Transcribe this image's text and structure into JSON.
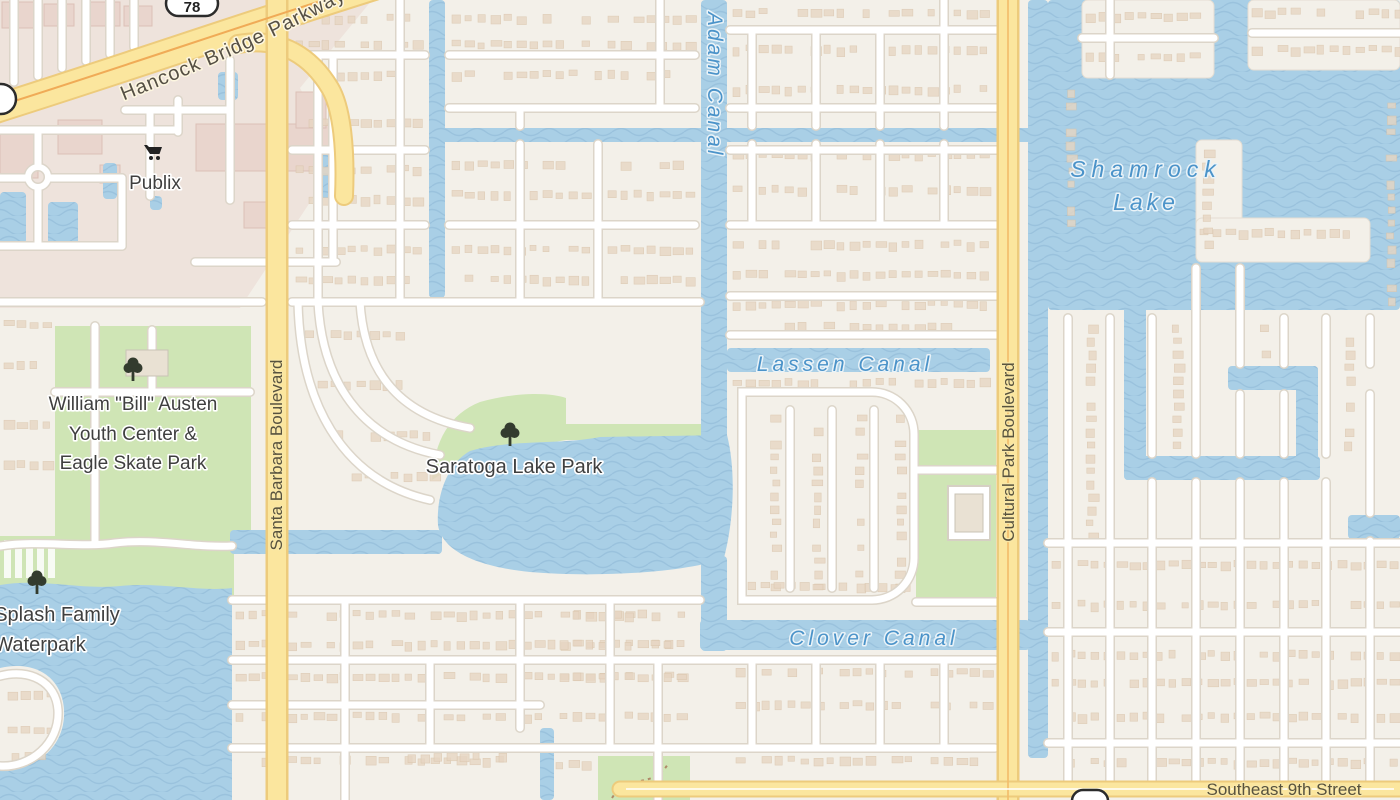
{
  "map": {
    "title": "Cape Coral neighborhood map",
    "labels": {
      "publix": "Publix",
      "youth_center_lines": [
        "William \"Bill\" Austen",
        "Youth Center &",
        "Eagle Skate Park"
      ],
      "saratoga_park": "Saratoga Lake Park",
      "splash_line1": "Splash Family",
      "splash_line2": "Waterpark",
      "adam_canal": "Adam Canal",
      "lassen_canal": "Lassen Canal",
      "clover_canal": "Clover Canal",
      "shamrock_line1": "Shamrock",
      "shamrock_line2": "Lake",
      "santa_barbara": "Santa Barbara Boulevard",
      "cultural_park": "Cultural Park Boulevard",
      "se_9th": "Southeast 9th Street",
      "hancock": "Hancock Bridge Parkway",
      "route_78": "78"
    },
    "icons": {
      "parks": "tree-icon",
      "publix": "shopping-cart-icon",
      "route": "highway-shield-icon"
    },
    "palette": {
      "land": "#f3f0e9",
      "commercial_zone": "#eee3dc",
      "commercial_building": "#e9d5cd",
      "commercial_building_stroke": "#dcc0b6",
      "house": "#e7d6c3",
      "house_stroke": "#d9c4ab",
      "street": "#ffffff",
      "street_casing": "#dcd5c9",
      "road": "#fbe69e",
      "road_casing": "#edcb7c",
      "road_center": "#f0ab57",
      "park": "#cfe5b5",
      "water": "#a9cfe6",
      "wave": "#8db8d4",
      "water_label": "#4b93c9",
      "tree": "#333b2e",
      "park_building": "#e9e1d3",
      "park_building_stroke": "#c9c3b6"
    }
  }
}
